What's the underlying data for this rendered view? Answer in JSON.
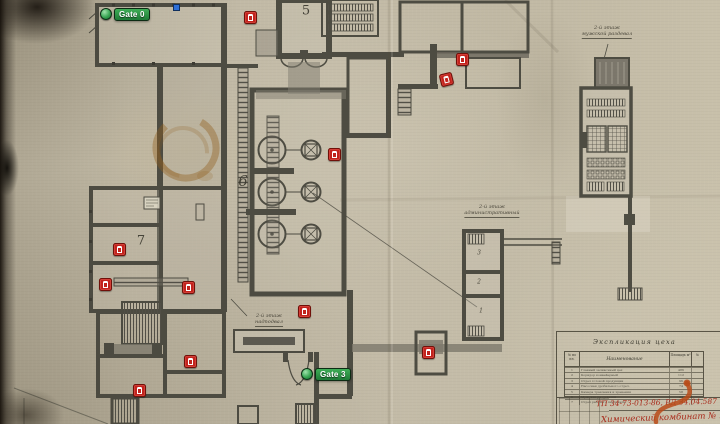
{
  "map": {
    "gates": [
      {
        "label": "Gate 0",
        "cx": 105,
        "cy": 14
      },
      {
        "label": "Gate 3",
        "cx": 306,
        "cy": 374
      }
    ],
    "markers": [
      {
        "x": 249,
        "y": 16
      },
      {
        "x": 461,
        "y": 58
      },
      {
        "x": 445,
        "y": 78,
        "rot": -14
      },
      {
        "x": 333,
        "y": 153
      },
      {
        "x": 118,
        "y": 248
      },
      {
        "x": 104,
        "y": 283
      },
      {
        "x": 187,
        "y": 286
      },
      {
        "x": 303,
        "y": 310
      },
      {
        "x": 189,
        "y": 360
      },
      {
        "x": 138,
        "y": 389
      },
      {
        "x": 427,
        "y": 351
      }
    ],
    "blue_marker": {
      "x": 175,
      "y": 6
    },
    "room_labels": [
      {
        "text": "5",
        "x": 306,
        "y": 11,
        "size": 13,
        "italic": false
      },
      {
        "text": "6",
        "x": 243,
        "y": 181,
        "size": 15,
        "italic": true
      },
      {
        "text": "7",
        "x": 141,
        "y": 241,
        "size": 13,
        "italic": false
      },
      {
        "text": "3",
        "x": 479,
        "y": 253,
        "size": 6,
        "italic": true
      },
      {
        "text": "2",
        "x": 479,
        "y": 282,
        "size": 6,
        "italic": true
      },
      {
        "text": "1",
        "x": 481,
        "y": 311,
        "size": 6,
        "italic": true
      }
    ],
    "annotations": [
      {
        "line1": "2-й этаж",
        "line2": "мужской раздевал",
        "cx": 607,
        "y": 26
      },
      {
        "line1": "2-й этаж",
        "line2": "административный",
        "cx": 492,
        "y": 205
      },
      {
        "line1": "2-й этаж",
        "line2": "надподвал",
        "cx": 269,
        "y": 314
      }
    ]
  },
  "title_block": {
    "header": "Экспликация цеха",
    "columns": {
      "num": "№ по пл.",
      "name": "Наименование",
      "area": "Площадь м²",
      "note": "№"
    },
    "rows": [
      {
        "num": "1",
        "name": "Главный заливочный цех",
        "area": "486"
      },
      {
        "num": "2",
        "name": "Коридор конвейерный",
        "area": "112"
      },
      {
        "num": "3",
        "name": "Отдел готовой продукции",
        "area": "96"
      },
      {
        "num": "4",
        "name": "Насосная дробильного отдел.",
        "area": "74"
      },
      {
        "num": "5",
        "name": "Камера травления и хранения",
        "area": "58"
      },
      {
        "num": "6",
        "name": "Мужские раздевалки",
        "area": "44"
      },
      {
        "num": "7",
        "name": "Отдел рабочего персонала",
        "area": "39"
      }
    ],
    "stamp_line1": "ТП 34-73-013-86, РД 34.04.587",
    "stamp_line2": "Химический комбинат № 16"
  },
  "colors": {
    "paper": "#bfb7a3",
    "wall": "#46443a",
    "marker_red": "#c2231d",
    "gate_green": "#2fa34c",
    "stamp_red": "#a8291a",
    "stain_brown": "#8a5a1e",
    "blue_marker": "#2e6fd6"
  }
}
